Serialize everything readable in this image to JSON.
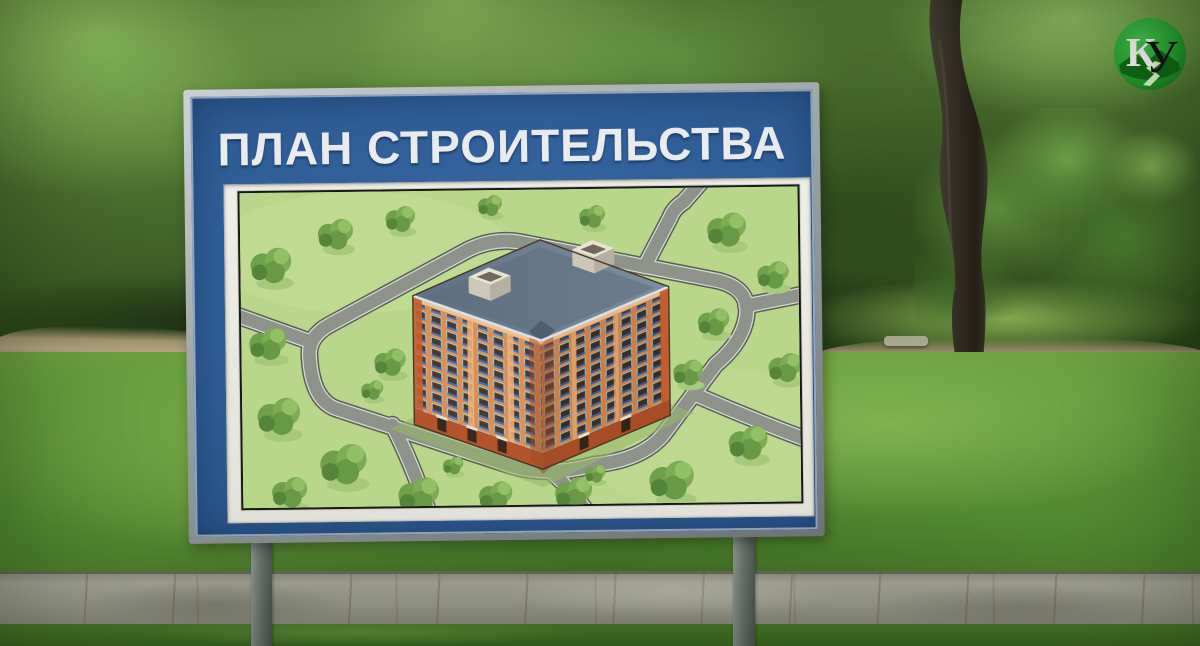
{
  "billboard": {
    "title": "ПЛАН СТРОИТЕЛЬСТВА",
    "panel_color": "#2e5c94",
    "frame_color": "#9aa1a4",
    "mat_color": "#e8e8e1",
    "title_color": "#e9eced"
  },
  "site_plan": {
    "lawn_color": "#b9d78a",
    "road_color": "#8d928b",
    "building_wall_color": "#dd8e55",
    "building_base_color": "#b5532c",
    "roof_color": "#68798a",
    "window_accent_color": "#3f74c0"
  },
  "logo": {
    "letter_k": "К",
    "letter_u": "У",
    "circle_color": "#27a331",
    "hills_color": "#0f6414"
  }
}
